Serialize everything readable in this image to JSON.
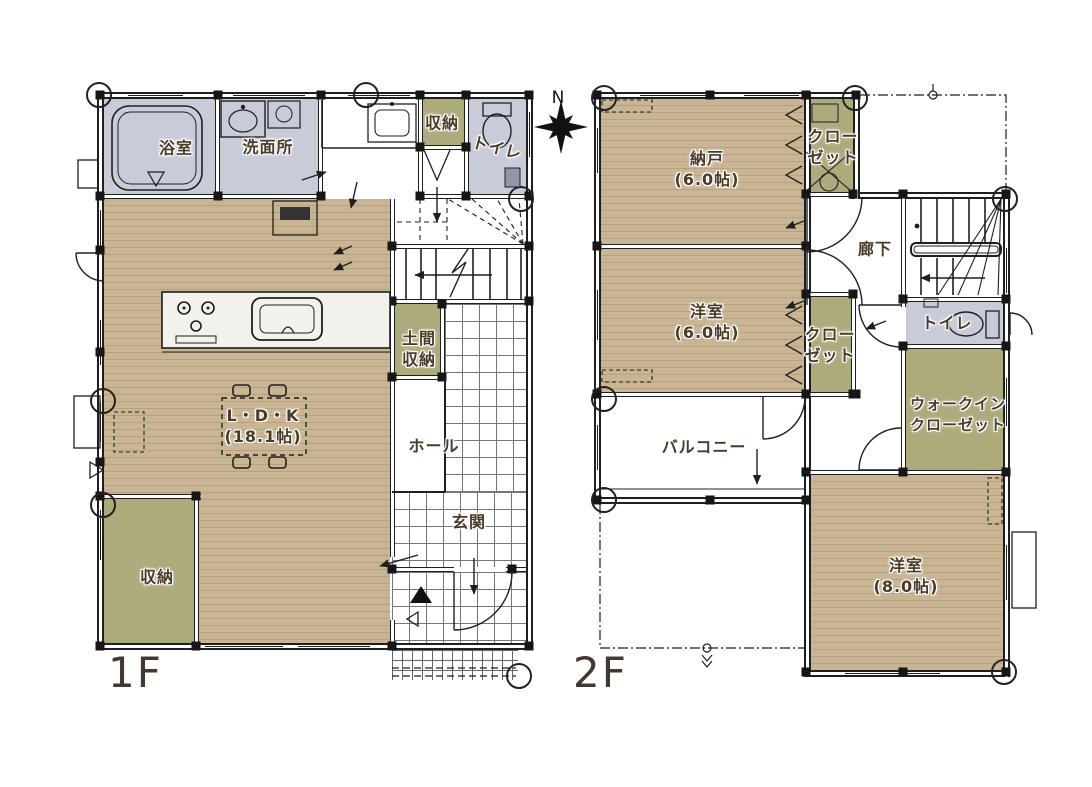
{
  "compass": {
    "north": "N"
  },
  "floor1": {
    "label": "1F",
    "rooms": {
      "bath": "浴室",
      "washroom": "洗面所",
      "storage_top": "収納",
      "toilet": "トイレ",
      "doma_line1": "土間",
      "doma_line2": "収納",
      "ldk": "L・D・K",
      "ldk_size": "(18.1帖)",
      "hall": "ホール",
      "genkan": "玄関",
      "storage_bottom": "収納"
    }
  },
  "floor2": {
    "label": "2F",
    "rooms": {
      "nando": "納戸",
      "nando_size": "(6.0帖)",
      "closet_top_line1": "クロー",
      "closet_top_line2": "ゼット",
      "hallway": "廊下",
      "bedroom6": "洋室",
      "bedroom6_size": "(6.0帖)",
      "closet_mid_line1": "クロー",
      "closet_mid_line2": "ゼット",
      "toilet": "トイレ",
      "wic_line1": "ウォークイン",
      "wic_line2": "クローゼット",
      "balcony": "バルコニー",
      "bedroom8": "洋室",
      "bedroom8_size": "(8.0帖)"
    }
  },
  "colors": {
    "wood": "#c9b493",
    "wood_stripe": "#b7a17e",
    "olive": "#adab7c",
    "wet": "#c8ccd8",
    "line": "#1f1f1f",
    "text": "#4a3a28",
    "floor_label": "#453831",
    "tile": "#777777"
  }
}
